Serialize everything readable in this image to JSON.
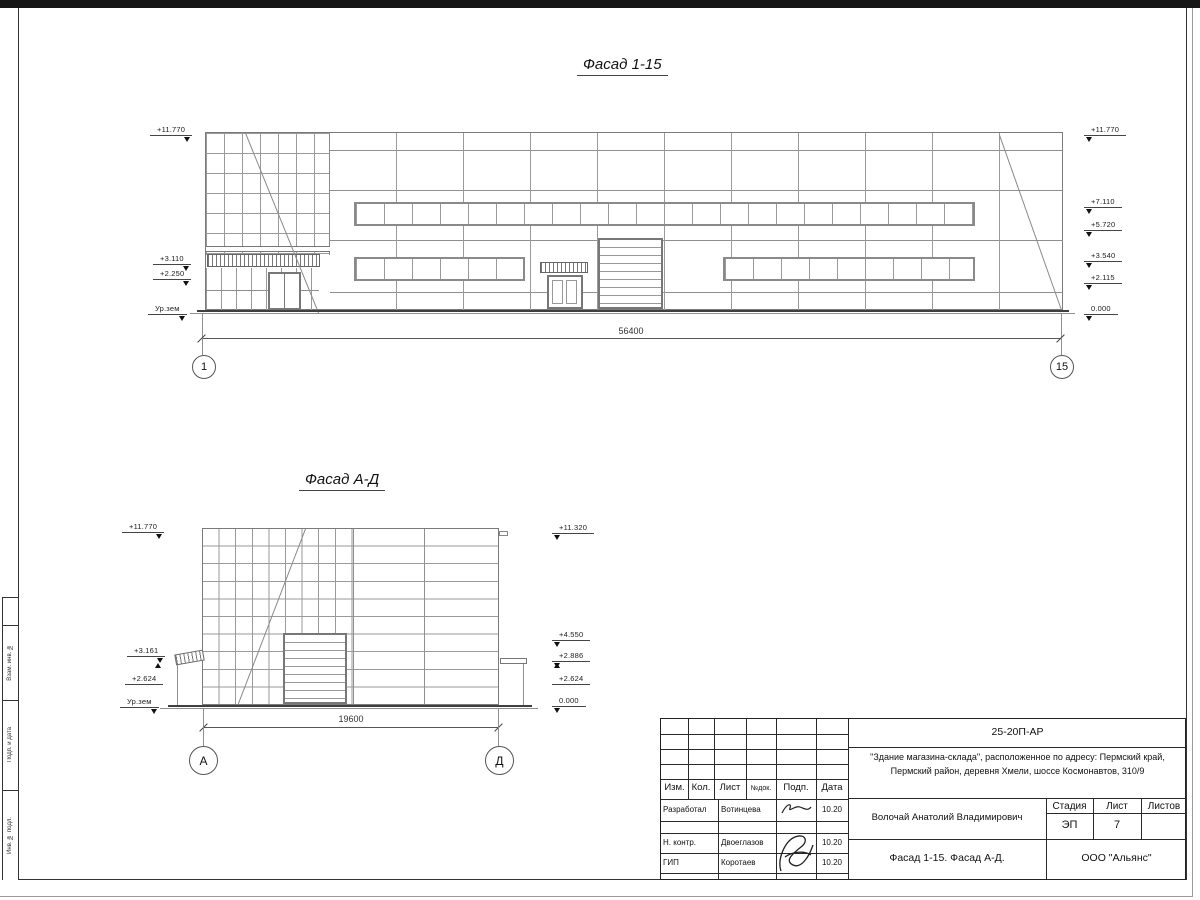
{
  "facade1": {
    "title": "Фасад 1-15",
    "dimension": "56400",
    "axis_left": "1",
    "axis_right": "15",
    "marks_left": [
      "+11.770",
      "+3.110",
      "+2.250",
      "Ур.зем"
    ],
    "marks_right": [
      "+11.770",
      "+7.110",
      "+5.720",
      "+3.540",
      "+2.115",
      "0.000"
    ]
  },
  "facade2": {
    "title": "Фасад А-Д",
    "dimension": "19600",
    "axis_left": "А",
    "axis_right": "Д",
    "marks_left": [
      "+11.770",
      "+3.161",
      "+2.624",
      "Ур.зем"
    ],
    "marks_right": [
      "+11.320",
      "+4.550",
      "+2.886",
      "+2.624",
      "0.000"
    ]
  },
  "titleblock": {
    "doc_code": "25-20П-АР",
    "project_line1": "\"Здание магазина-склада\", расположенное по адресу: Пермский край,",
    "project_line2": "Пермский район, деревня Хмели, шоссе Космонавтов, 310/9",
    "col_izm": "Изм.",
    "col_kol": "Кол.",
    "col_list": "Лист",
    "col_ndok": "№док.",
    "col_podp": "Подп.",
    "col_data": "Дата",
    "rows": [
      {
        "role": "Разработал",
        "name": "Вотинцева",
        "date": "10.20"
      },
      {
        "role": "Н. контр.",
        "name": "Двоеглазов",
        "date": "10.20"
      },
      {
        "role": "ГИП",
        "name": "Коротаев",
        "date": "10.20"
      }
    ],
    "supervisor": "Волочай Анатолий Владимирович",
    "stage_label": "Стадия",
    "sheet_label": "Лист",
    "sheets_label": "Листов",
    "stage_value": "ЭП",
    "sheet_value": "7",
    "drawing_title": "Фасад 1-15. Фасад А-Д.",
    "company": "ООО \"Альянс\""
  },
  "side_stamp": {
    "labels": [
      "Взам. инв. №",
      "Подп. и дата",
      "Инв. № подл."
    ]
  }
}
